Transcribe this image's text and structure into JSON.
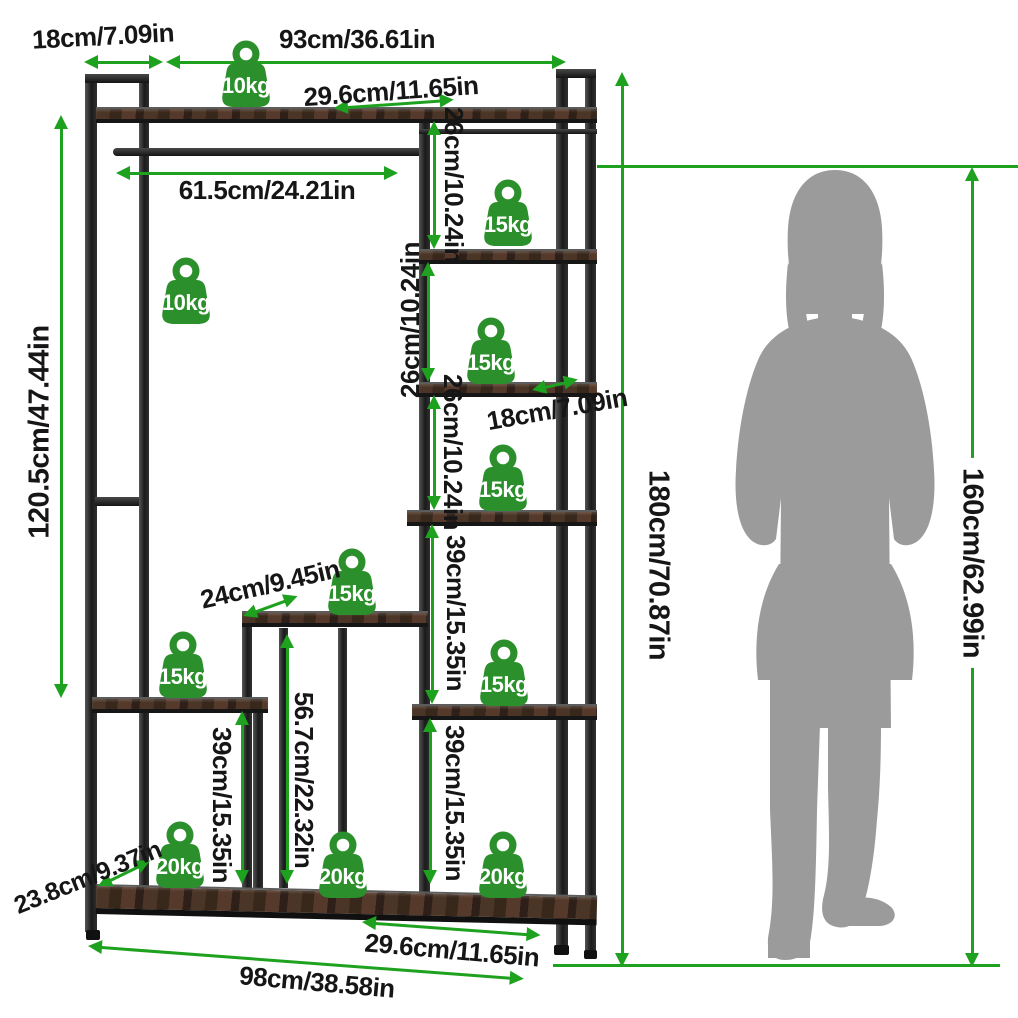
{
  "diagram": {
    "type": "product-dimension-diagram",
    "product": "freestanding garment rack with ladder shelves",
    "colors": {
      "dimension_green": "#1ea11e",
      "badge_green": "#2b8f2b",
      "silhouette_gray": "#9b9b9b",
      "text": "#161616"
    }
  },
  "labels": {
    "top_depth": "18cm/7.09in",
    "top_width": "93cm/36.61in",
    "top_shelf_depth": "29.6cm/11.65in",
    "rod_width": "61.5cm/24.21in",
    "left_height": "120.5cm/47.44in",
    "shelf_gap_26_a": "26cm/10.24in",
    "shelf_gap_26_b": "26cm/10.24in",
    "shelf_gap_26_c": "26cm/10.24in",
    "mid_shelf_depth_right": "18cm/7.09in",
    "shelf_gap_39_right_upper": "39cm/15.35in",
    "shelf_gap_39_right_lower": "39cm/15.35in",
    "mid_shelf_depth": "24cm/9.45in",
    "shelf_gap_39_left": "39cm/15.35in",
    "mid_column_height": "56.7cm/22.32in",
    "total_height": "180cm/70.87in",
    "person_height": "160cm/62.99in",
    "base_depth": "23.8cm/9.37in",
    "base_shelf_width": "29.6cm/11.65in",
    "total_width": "98cm/38.58in"
  },
  "badges": [
    {
      "position": "top-shelf",
      "label": "10kg"
    },
    {
      "position": "hanging-rod",
      "label": "10kg"
    },
    {
      "position": "right-tower-shelf-1",
      "label": "15kg"
    },
    {
      "position": "right-tower-shelf-2",
      "label": "15kg"
    },
    {
      "position": "right-tower-shelf-3",
      "label": "15kg"
    },
    {
      "position": "middle-shelf",
      "label": "15kg"
    },
    {
      "position": "left-shelf",
      "label": "15kg"
    },
    {
      "position": "right-tower-shelf-4",
      "label": "15kg"
    },
    {
      "position": "base-left",
      "label": "20kg"
    },
    {
      "position": "base-middle",
      "label": "20kg"
    },
    {
      "position": "base-right",
      "label": "20kg"
    }
  ]
}
